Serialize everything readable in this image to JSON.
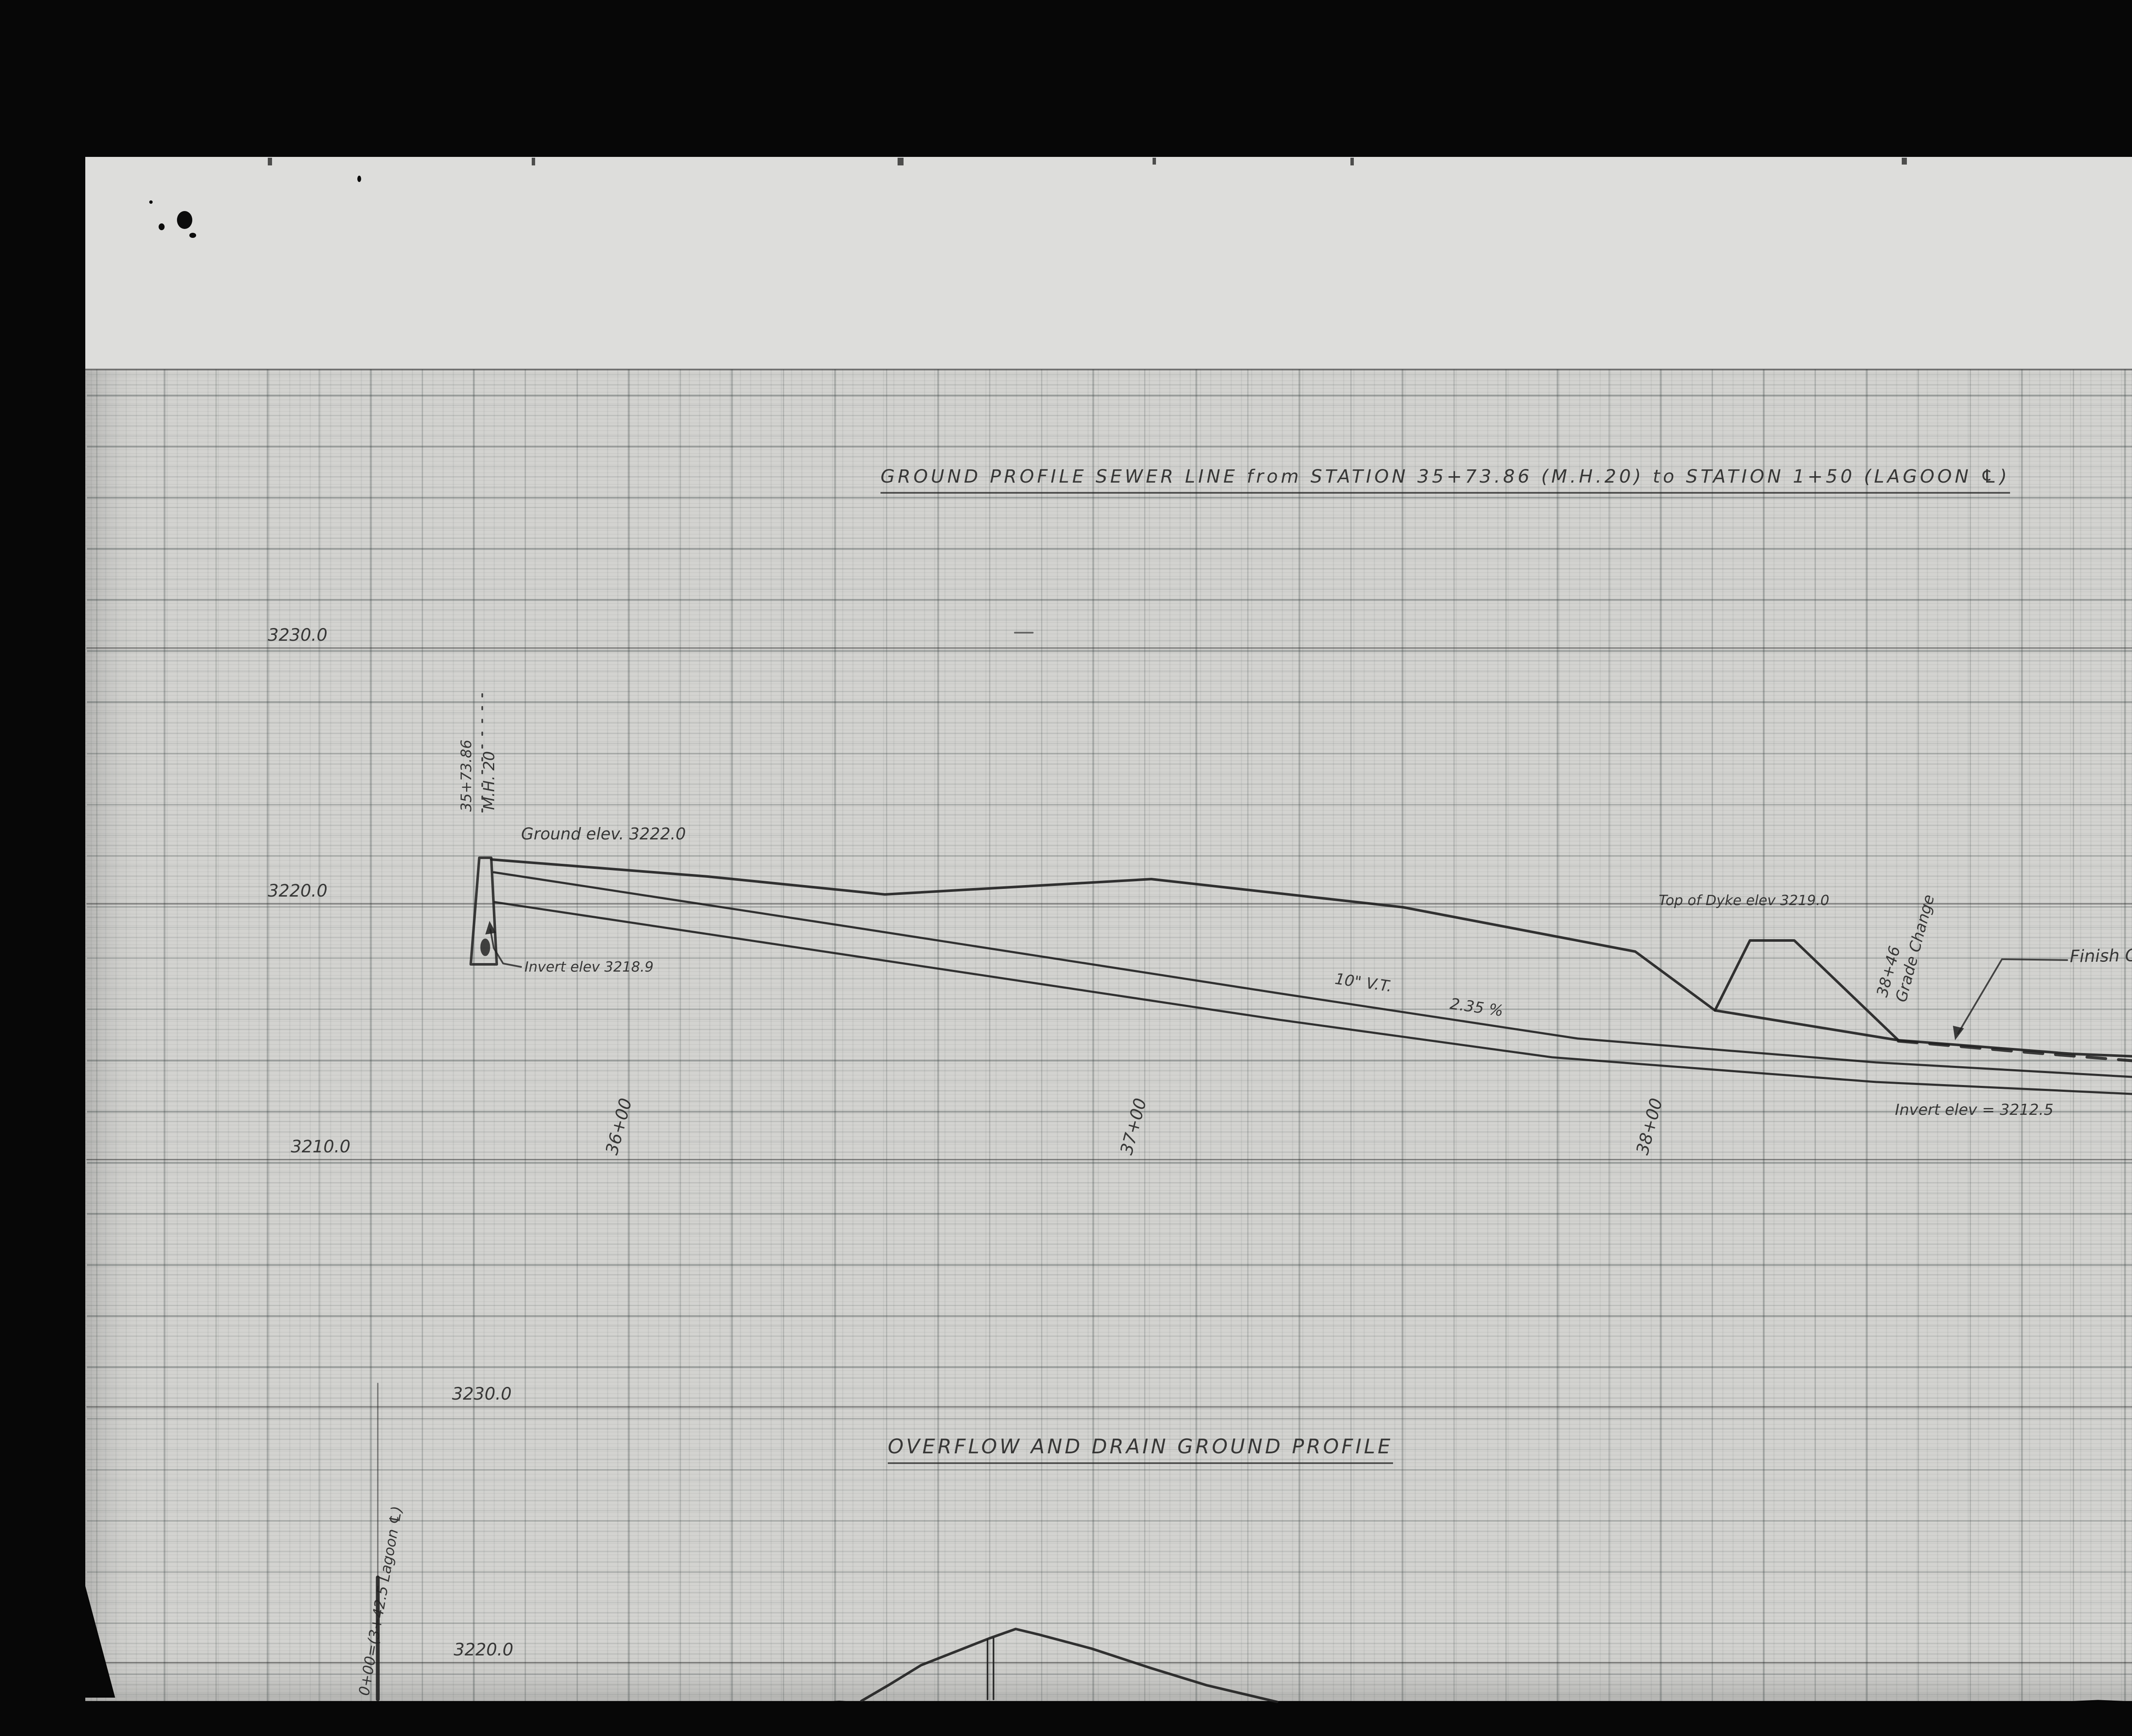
{
  "film": {
    "counter": "001498",
    "page_label": "1 OF / DE",
    "archives_card": {
      "line1": "National Archives of Canada",
      "line2": "Archives nationales du Canada"
    },
    "reference_strip": {
      "line1": "RG 84, A-2-a, vol. 1647",
      "line2": "File/dossier K36 Redstreak Plan",
      "line3": "pt. 1"
    },
    "parks_stamp": {
      "line1": "PARKS CANADA",
      "line2": "PARCS CANADA"
    }
  },
  "sheet": {
    "title_top": "GROUND PROFILE SEWER LINE from STATION 35+73.86 (M.H.20) to STATION 1+50 (LAGOON ℄)",
    "title_bottom": "OVERFLOW AND DRAIN GROUND PROFILE",
    "elevations_top": [
      "3230.0",
      "3220.0",
      "3210.0"
    ],
    "elevations_bottom": [
      "3230.0",
      "3220.0"
    ],
    "stations": [
      "36+00",
      "37+00",
      "38+00",
      "39+00"
    ],
    "manhole": {
      "station": "35+73.86",
      "name": "M.H. 20"
    },
    "labels": {
      "ground_elev": "Ground elev. 3222.0",
      "invert_mh": "Invert elev 3218.9",
      "pipe": "10\" V.T.",
      "grade": "2.35 %",
      "dyke": "Top of Dyke elev 3219.0",
      "grade_change_sta": "38+46",
      "grade_change": "Grade Change",
      "finish_grade": "Finish Grade of Lagoon",
      "invert_lagoon": "Invert elev = 3212.5",
      "pipe_right": "10\"",
      "zero_station": "0+00=(3+42.5 Lagoon ℄)"
    }
  },
  "chart_data": {
    "type": "line",
    "title": "GROUND PROFILE SEWER LINE from STATION 35+73.86 (M.H.20) to STATION 1+50 (LAGOON ℄)",
    "ylabel": "Elevation (ft)",
    "ylim": [
      3205,
      3232
    ],
    "x_ticks": [
      "36+00",
      "37+00",
      "38+00",
      "39+00"
    ],
    "series": [
      {
        "name": "Ground profile",
        "x": [
          "35+74",
          "36+50",
          "37+00",
          "38+00",
          "38+46",
          "39+40"
        ],
        "y": [
          3222.0,
          3221.2,
          3221.9,
          3219.7,
          3219.0,
          3217.6
        ]
      },
      {
        "name": "Sewer pipe 10\" V.T. @ 2.35 %",
        "x": [
          "35+74",
          "39+40"
        ],
        "y": [
          3218.9,
          3212.5
        ]
      },
      {
        "name": "Top of Dyke",
        "x": [
          "38+40",
          "38+52"
        ],
        "y": [
          3219.0,
          3219.0
        ]
      },
      {
        "name": "Finish Grade of Lagoon (dashed)",
        "x": [
          "38+60",
          "39+40"
        ],
        "y": [
          3213.6,
          3212.6
        ]
      }
    ],
    "annotations": [
      "Ground elev. 3222.0",
      "Invert elev 3218.9",
      "Top of Dyke elev 3219.0",
      "38+46 Grade Change",
      "Finish Grade of Lagoon",
      "Invert elev = 3212.5"
    ]
  },
  "drawing": {
    "shapes": [
      {
        "name": "gridline-3230-top",
        "type": "polyline",
        "points": [
          [
            204,
            1520
          ],
          [
            5565,
            1520
          ]
        ],
        "w": 3,
        "o": 0.5
      },
      {
        "name": "gridline-3220-top",
        "type": "polyline",
        "points": [
          [
            204,
            2120
          ],
          [
            5565,
            2120
          ]
        ],
        "w": 3,
        "o": 0.5
      },
      {
        "name": "gridline-3210-top",
        "type": "polyline",
        "points": [
          [
            204,
            2720
          ],
          [
            5565,
            2720
          ]
        ],
        "w": 3,
        "o": 0.5
      },
      {
        "name": "gridline-3230-bottom",
        "type": "polyline",
        "points": [
          [
            204,
            3300
          ],
          [
            5565,
            3300
          ]
        ],
        "w": 3,
        "o": 0.5
      },
      {
        "name": "gridline-3220-bottom",
        "type": "polyline",
        "points": [
          [
            204,
            3900
          ],
          [
            5565,
            3900
          ]
        ],
        "w": 3,
        "o": 0.5
      },
      {
        "name": "mh-station-line",
        "type": "polyline",
        "points": [
          [
            1131,
            1628
          ],
          [
            1131,
            1922
          ]
        ],
        "w": 4,
        "dash": "6 24",
        "o": 0.8
      },
      {
        "name": "manhole-outline",
        "type": "polygon",
        "points": [
          [
            1124,
            2012
          ],
          [
            1152,
            2012
          ],
          [
            1165,
            2262
          ],
          [
            1104,
            2262
          ]
        ],
        "fill": "none",
        "stroke": "#1f1f1f",
        "w": 6
      },
      {
        "name": "manhole-ink-blot",
        "type": "ellipse",
        "cx": 1138,
        "cy": 2222,
        "rx": 11,
        "ry": 20,
        "fill": "#1c1c1c",
        "o": 0.8
      },
      {
        "name": "ground-profile-line",
        "type": "polyline",
        "points": [
          [
            1152,
            2016
          ],
          [
            1660,
            2056
          ],
          [
            2075,
            2098
          ],
          [
            2700,
            2062
          ],
          [
            3290,
            2128
          ],
          [
            3835,
            2232
          ],
          [
            4022,
            2370
          ],
          [
            4452,
            2440
          ],
          [
            4860,
            2472
          ],
          [
            5260,
            2488
          ],
          [
            5565,
            2492
          ]
        ],
        "w": 6,
        "o": 0.9
      },
      {
        "name": "dyke-outline",
        "type": "polyline",
        "points": [
          [
            4022,
            2370
          ],
          [
            4104,
            2206
          ],
          [
            4208,
            2206
          ],
          [
            4452,
            2440
          ]
        ],
        "w": 6,
        "o": 0.9
      },
      {
        "name": "finish-grade-dashed",
        "type": "polyline",
        "points": [
          [
            4452,
            2442
          ],
          [
            4750,
            2468
          ],
          [
            5100,
            2496
          ],
          [
            5400,
            2516
          ],
          [
            5565,
            2524
          ]
        ],
        "w": 7,
        "dash": "44 30",
        "o": 0.85
      },
      {
        "name": "pipe-top-line",
        "type": "polyline",
        "points": [
          [
            1158,
            2046
          ],
          [
            2000,
            2175
          ],
          [
            3000,
            2330
          ],
          [
            3700,
            2436
          ],
          [
            4400,
            2492
          ],
          [
            5000,
            2526
          ],
          [
            5565,
            2542
          ]
        ],
        "w": 5,
        "o": 0.9
      },
      {
        "name": "pipe-invert-line",
        "type": "polyline",
        "points": [
          [
            1160,
            2116
          ],
          [
            2000,
            2242
          ],
          [
            3000,
            2392
          ],
          [
            3640,
            2480
          ],
          [
            4400,
            2538
          ],
          [
            5000,
            2566
          ],
          [
            5565,
            2578
          ]
        ],
        "w": 5,
        "o": 0.9
      },
      {
        "name": "invert-leader",
        "type": "polyline",
        "points": [
          [
            1222,
            2268
          ],
          [
            1180,
            2260
          ],
          [
            1158,
            2224
          ],
          [
            1150,
            2180
          ]
        ],
        "w": 4,
        "o": 0.8
      },
      {
        "name": "invert-arrowhead",
        "type": "polygon",
        "points": [
          [
            1148,
            2160
          ],
          [
            1138,
            2192
          ],
          [
            1163,
            2188
          ]
        ],
        "fill": "#1f1f1f",
        "o": 0.85
      },
      {
        "name": "finish-grade-leader",
        "type": "polyline",
        "points": [
          [
            4848,
            2252
          ],
          [
            4695,
            2250
          ],
          [
            4592,
            2424
          ]
        ],
        "w": 4,
        "o": 0.8
      },
      {
        "name": "finish-grade-arrowhead",
        "type": "polygon",
        "points": [
          [
            4585,
            2440
          ],
          [
            4580,
            2406
          ],
          [
            4606,
            2412
          ]
        ],
        "fill": "#1f1f1f",
        "o": 0.85
      },
      {
        "name": "overflow-mound-line",
        "type": "polyline",
        "points": [
          [
            2020,
            3990
          ],
          [
            2085,
            3952
          ],
          [
            2160,
            3906
          ],
          [
            2320,
            3843
          ],
          [
            2382,
            3821
          ],
          [
            2436,
            3834
          ],
          [
            2560,
            3867
          ],
          [
            2700,
            3913
          ],
          [
            2830,
            3953
          ],
          [
            2995,
            3992
          ]
        ],
        "w": 6,
        "o": 0.9
      },
      {
        "name": "mound-pipe-left",
        "type": "polyline",
        "points": [
          [
            2316,
            3846
          ],
          [
            2316,
            3986
          ]
        ],
        "w": 4,
        "o": 0.9
      },
      {
        "name": "mound-pipe-right",
        "type": "polyline",
        "points": [
          [
            2330,
            3843
          ],
          [
            2330,
            3986
          ]
        ],
        "w": 4,
        "o": 0.9
      },
      {
        "name": "lagoon-zero-line-thin",
        "type": "polyline",
        "points": [
          [
            886,
            3245
          ],
          [
            886,
            3700
          ]
        ],
        "w": 3,
        "o": 0.55
      },
      {
        "name": "lagoon-zero-line-thick",
        "type": "polyline",
        "points": [
          [
            886,
            3700
          ],
          [
            886,
            3986
          ]
        ],
        "w": 9,
        "o": 0.9
      },
      {
        "name": "grid-top-edge-line",
        "type": "polyline",
        "points": [
          [
            200,
            866
          ],
          [
            5724,
            866
          ]
        ],
        "w": 3,
        "o": 0.4
      },
      {
        "name": "small-cross-mark",
        "type": "polyline",
        "points": [
          [
            2380,
            1484
          ],
          [
            2422,
            1484
          ]
        ],
        "w": 4,
        "o": 0.6
      }
    ]
  }
}
